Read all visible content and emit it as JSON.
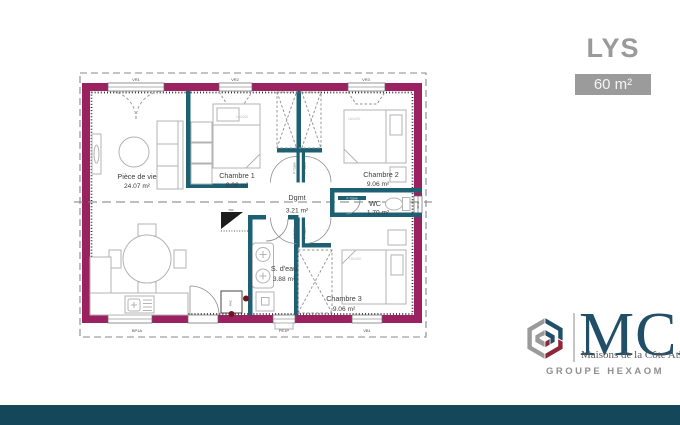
{
  "title": "LYS",
  "area_badge": "60 m²",
  "rooms": {
    "living": {
      "name": "Pièce de vie",
      "area": "24.07 m²"
    },
    "bedroom1": {
      "name": "Chambre 1",
      "area": "9.06 m²"
    },
    "bedroom2": {
      "name": "Chambre 2",
      "area": "9.06 m²"
    },
    "hallway": {
      "name": "Dgmt",
      "area": "3.21 m²"
    },
    "wc": {
      "name": "WC",
      "area": "1.70 m²"
    },
    "bathroom": {
      "name": "S. d'eau",
      "area": "3.88 m²"
    },
    "bedroom3": {
      "name": "Chambre 3",
      "area": "9.06 m²"
    }
  },
  "annotations": {
    "bed_size": "140x200",
    "door_code": "P T3204",
    "wc_door_code": "P 73204",
    "pac_label": "PAC",
    "tdf_label": "TDF",
    "window_codes": {
      "top1": "VR1",
      "top2": "VR2",
      "top3": "VR3",
      "bottom1": "BP1A",
      "bottom2": "PE1P",
      "bottom3": "VB1",
      "right1": "SF10"
    }
  },
  "branding": {
    "logo": "MCA",
    "tagline": "Maisons de la Côte Atlantique",
    "group": "GROUPE HEXAOM"
  },
  "colors": {
    "exterior_wall": "#9b2160",
    "interior_wall": "#1d6073",
    "accent_bar": "#15475a",
    "badge_bg": "#9b9b9b",
    "logo_navy": "#224f68",
    "logo_burgundy": "#8e2638",
    "logo_gray": "#9a9a9a"
  }
}
